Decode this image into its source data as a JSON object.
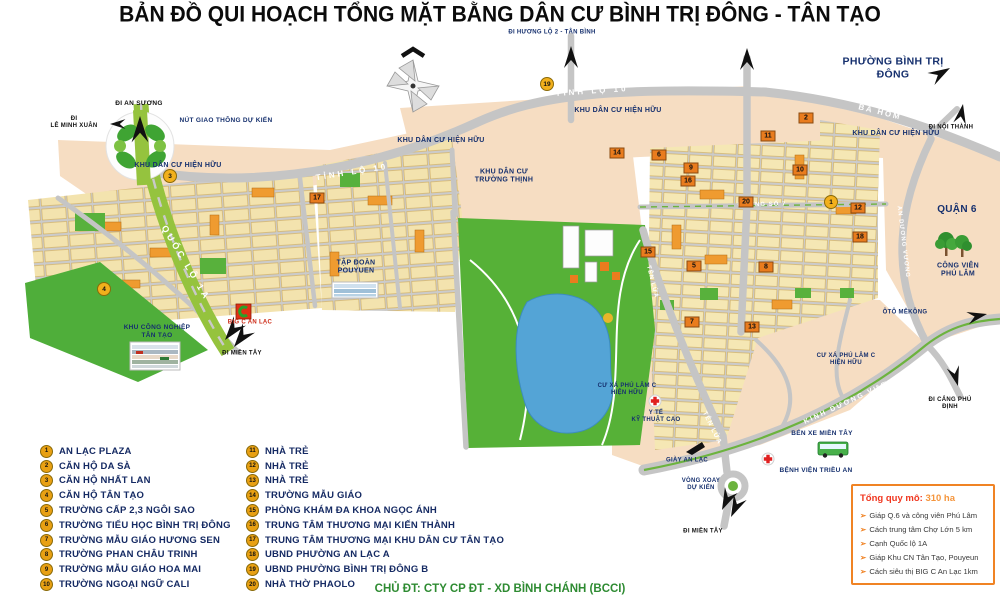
{
  "title": "BẢN ĐỒ QUI HOẠCH TỔNG MẶT BẰNG DÂN CƯ BÌNH TRỊ ĐÔNG - TÂN TẠO",
  "legend": {
    "items": [
      {
        "num": "1",
        "label": "AN LẠC PLAZA"
      },
      {
        "num": "2",
        "label": "CĂN HỘ DA SÀ"
      },
      {
        "num": "3",
        "label": "CĂN HỘ NHẤT LAN"
      },
      {
        "num": "4",
        "label": "CĂN HỘ TÂN TẠO"
      },
      {
        "num": "5",
        "label": "TRƯỜNG CẤP 2,3 NGÔI SAO"
      },
      {
        "num": "6",
        "label": "TRƯỜNG TIỂU HỌC BÌNH TRỊ ĐÔNG"
      },
      {
        "num": "7",
        "label": "TRƯỜNG MẪU GIÁO HƯƠNG SEN"
      },
      {
        "num": "8",
        "label": "TRƯỜNG PHAN CHÂU TRINH"
      },
      {
        "num": "9",
        "label": "TRƯỜNG MẪU GIÁO HOA MAI"
      },
      {
        "num": "10",
        "label": "TRƯỜNG NGOẠI NGỮ CALI"
      },
      {
        "num": "11",
        "label": "NHÀ TRẺ"
      },
      {
        "num": "12",
        "label": "NHÀ TRẺ"
      },
      {
        "num": "13",
        "label": "NHÀ TRẺ"
      },
      {
        "num": "14",
        "label": "TRƯỜNG MẪU GIÁO"
      },
      {
        "num": "15",
        "label": "PHÒNG KHÁM ĐA KHOA NGỌC ÁNH"
      },
      {
        "num": "16",
        "label": "TRUNG TÂM THƯƠNG MẠI KIẾN THÀNH"
      },
      {
        "num": "17",
        "label": "TRUNG TÂM THƯƠNG MẠI KHU DÂN CƯ TÂN TẠO"
      },
      {
        "num": "18",
        "label": "UBND PHƯỜNG AN LẠC A"
      },
      {
        "num": "19",
        "label": "UBND PHƯỜNG BÌNH TRỊ ĐÔNG B"
      },
      {
        "num": "20",
        "label": "NHÀ THỜ PHAOLO"
      }
    ]
  },
  "info_box": {
    "title_label": "Tổng quy mô:",
    "title_value": "310 ha",
    "bullets": [
      "Giáp Q.6 và công viên Phú Lâm",
      "Cách trung tâm Chợ Lớn 5 km",
      "Cạnh Quốc lộ 1A",
      "Giáp Khu CN Tân Tạo, Pouyeun",
      "Cách siêu thị BIG C An Lạc 1km"
    ]
  },
  "footer": {
    "developer": "CHỦ ĐT: CTY CP ĐT - XD BÌNH CHÁNH (BCCI)"
  },
  "map": {
    "colors": {
      "accent_orange": "#f08324",
      "navy": "#16306e",
      "road_gray": "#c5c5c5",
      "park_green": "#56b137",
      "lake_blue": "#54a4d6",
      "highway_green": "#95c33e",
      "beige": "#f6ddc2",
      "block_yellow": "#f3e3ae",
      "marker_gold": "#f2b01c",
      "marker_orange": "#e97c1e",
      "footer_green": "#2e8b32"
    },
    "area_labels": [
      {
        "text": "ĐI HƯƠNG LỘ 2 - TÂN BÌNH",
        "x": 552,
        "y": 33,
        "size": 6,
        "color": "navy",
        "name": "label-di-huong-lo-2-tan-binh"
      },
      {
        "text": "PHƯỜNG BÌNH TRỊ ĐÔNG",
        "x": 893,
        "y": 68,
        "size": 10.5,
        "color": "navy",
        "name": "label-phuong-binh-tri-dong"
      },
      {
        "text": "ĐI NỘI THÀNH",
        "x": 951,
        "y": 128,
        "size": 6,
        "color": "black",
        "name": "label-di-noi-thanh"
      },
      {
        "text": "KHU DÂN CƯ HIỆN HỮU",
        "x": 178,
        "y": 166,
        "size": 7,
        "color": "navy",
        "name": "label-kdc-hien-huu-1"
      },
      {
        "text": "KHU DÂN CƯ HIỆN HỮU",
        "x": 441,
        "y": 141,
        "size": 7,
        "color": "navy",
        "name": "label-kdc-hien-huu-2"
      },
      {
        "text": "KHU DÂN CƯ HIỆN HỮU",
        "x": 618,
        "y": 111,
        "size": 7,
        "color": "navy",
        "name": "label-kdc-hien-huu-3"
      },
      {
        "text": "KHU DÂN CƯ HIỆN HỮU",
        "x": 896,
        "y": 134,
        "size": 7,
        "color": "navy",
        "name": "label-kdc-hien-huu-4"
      },
      {
        "text": "KHU DÂN CƯ\nTRƯỜNG THỊNH",
        "x": 504,
        "y": 177,
        "size": 7,
        "color": "navy",
        "name": "label-kdc-truong-thinh"
      },
      {
        "text": "ĐI AN SƯƠNG",
        "x": 139,
        "y": 104,
        "size": 6.5,
        "color": "black",
        "name": "label-di-an-suong"
      },
      {
        "text": "ĐI\nLÊ MINH XUÂN",
        "x": 74,
        "y": 123,
        "size": 6,
        "color": "black",
        "name": "label-di-le-minh-xuan"
      },
      {
        "text": "NÚT GIAO THÔNG DỰ KIẾN",
        "x": 226,
        "y": 121,
        "size": 6.5,
        "color": "navy",
        "name": "label-nut-giao-thong-du-kien"
      },
      {
        "text": "TẬP ĐOÀN\nPOUYUEN",
        "x": 356,
        "y": 268,
        "size": 7,
        "color": "navy",
        "name": "label-tap-doan-pouyuen"
      },
      {
        "text": "KHU CÔNG NGHIỆP\nTÂN TẠO",
        "x": 157,
        "y": 332,
        "size": 6.5,
        "color": "navy",
        "name": "label-kcn-tan-tao"
      },
      {
        "text": "BIG C AN LẠC",
        "x": 250,
        "y": 323,
        "size": 6,
        "color": "red",
        "name": "label-big-c-an-lac"
      },
      {
        "text": "ĐI MIỀN TÂY",
        "x": 242,
        "y": 354,
        "size": 6,
        "color": "black",
        "name": "label-di-mien-tay-1"
      },
      {
        "text": "QUẬN 6",
        "x": 957,
        "y": 210,
        "size": 10,
        "color": "navy",
        "name": "label-quan-6"
      },
      {
        "text": "CÔNG VIÊN\nPHÚ LÂM",
        "x": 958,
        "y": 271,
        "size": 7,
        "color": "navy",
        "name": "label-cong-vien-phu-lam"
      },
      {
        "text": "ÔTÔ MÊKÔNG",
        "x": 905,
        "y": 313,
        "size": 6,
        "color": "navy",
        "name": "label-oto-mekong"
      },
      {
        "text": "ĐI CẢNG PHÚ ĐỊNH",
        "x": 950,
        "y": 404,
        "size": 6,
        "color": "black",
        "name": "label-di-cang-phu-dinh"
      },
      {
        "text": "BẾN XE MIỀN TÂY",
        "x": 822,
        "y": 434,
        "size": 6.5,
        "color": "navy",
        "name": "label-ben-xe-mien-tay"
      },
      {
        "text": "BỆNH VIỆN TRIỀU AN",
        "x": 816,
        "y": 471,
        "size": 6.5,
        "color": "navy",
        "name": "label-benh-vien-trieu-an"
      },
      {
        "text": "VÒNG XOAY\nDỰ KIẾN",
        "x": 701,
        "y": 485,
        "size": 6,
        "color": "navy",
        "name": "label-vong-xoay-du-kien"
      },
      {
        "text": "ĐI MIỀN TÂY",
        "x": 703,
        "y": 532,
        "size": 6,
        "color": "black",
        "name": "label-di-mien-tay-2"
      },
      {
        "text": "GIÀY AN LẠC",
        "x": 687,
        "y": 461,
        "size": 6,
        "color": "navy",
        "name": "label-giay-an-lac"
      },
      {
        "text": "Y TẾ\nKỸ THUẬT CAO",
        "x": 656,
        "y": 417,
        "size": 6,
        "color": "navy",
        "name": "label-y-te-ky-thuat-cao"
      },
      {
        "text": "CƯ XÁ PHÚ LÂM C\nHIỆN HỮU",
        "x": 846,
        "y": 360,
        "size": 6,
        "color": "navy",
        "name": "label-cu-xa-phu-lam-1"
      },
      {
        "text": "CƯ XÁ PHÚ LÂM C\nHIỆN HỮU",
        "x": 627,
        "y": 390,
        "size": 6,
        "color": "navy",
        "name": "label-cu-xa-phu-lam-2"
      }
    ],
    "road_labels": [
      {
        "text": "TỈNH LỘ 10",
        "x": 352,
        "y": 172,
        "rot": -9,
        "size": 8,
        "ls": 3,
        "name": "road-tinh-lo-10-west"
      },
      {
        "text": "TỈNH LỘ 10",
        "x": 592,
        "y": 91,
        "rot": -4,
        "size": 8,
        "ls": 3,
        "name": "road-tinh-lo-10-east"
      },
      {
        "text": "BA HOM",
        "x": 880,
        "y": 112,
        "rot": 14,
        "size": 8,
        "ls": 2,
        "name": "road-ba-hom"
      },
      {
        "text": "AN DƯƠNG VƯƠNG",
        "x": 903,
        "y": 242,
        "rot": 83,
        "size": 6,
        "ls": 1,
        "name": "road-an-duong-vuong"
      },
      {
        "text": "KINH DƯƠNG VƯƠNG",
        "x": 853,
        "y": 400,
        "rot": -25,
        "size": 7,
        "ls": 2,
        "name": "road-kinh-duong-vuong"
      },
      {
        "text": "TÊN LỬA",
        "x": 712,
        "y": 428,
        "rot": 64,
        "size": 6.5,
        "ls": 1,
        "name": "road-ten-lua-south"
      },
      {
        "text": "TÊN LỬA",
        "x": 652,
        "y": 282,
        "rot": 76,
        "size": 6,
        "ls": 1,
        "name": "road-ten-lua-north"
      },
      {
        "text": "QUỐC LỘ 1A",
        "x": 186,
        "y": 263,
        "rot": 59,
        "size": 9,
        "ls": 3,
        "name": "road-quoc-lo-1a"
      },
      {
        "text": "ĐƯỜNG SỐ 7",
        "x": 762,
        "y": 205,
        "rot": -1,
        "size": 6,
        "ls": 1,
        "name": "road-duong-so-7"
      }
    ],
    "markers": {
      "circles": [
        {
          "num": "1",
          "x": 831,
          "y": 202
        },
        {
          "num": "3",
          "x": 170,
          "y": 176
        },
        {
          "num": "4",
          "x": 104,
          "y": 289
        },
        {
          "num": "19",
          "x": 547,
          "y": 84
        }
      ],
      "blocks": [
        {
          "num": "2",
          "x": 806,
          "y": 118
        },
        {
          "num": "5",
          "x": 694,
          "y": 266
        },
        {
          "num": "6",
          "x": 659,
          "y": 155
        },
        {
          "num": "7",
          "x": 692,
          "y": 322
        },
        {
          "num": "8",
          "x": 766,
          "y": 267
        },
        {
          "num": "9",
          "x": 691,
          "y": 168
        },
        {
          "num": "10",
          "x": 800,
          "y": 170
        },
        {
          "num": "11",
          "x": 768,
          "y": 136
        },
        {
          "num": "12",
          "x": 858,
          "y": 208
        },
        {
          "num": "13",
          "x": 752,
          "y": 327
        },
        {
          "num": "14",
          "x": 617,
          "y": 153
        },
        {
          "num": "15",
          "x": 648,
          "y": 252
        },
        {
          "num": "16",
          "x": 688,
          "y": 181
        },
        {
          "num": "17",
          "x": 317,
          "y": 198
        },
        {
          "num": "18",
          "x": 860,
          "y": 237
        },
        {
          "num": "20",
          "x": 746,
          "y": 202
        }
      ]
    }
  }
}
